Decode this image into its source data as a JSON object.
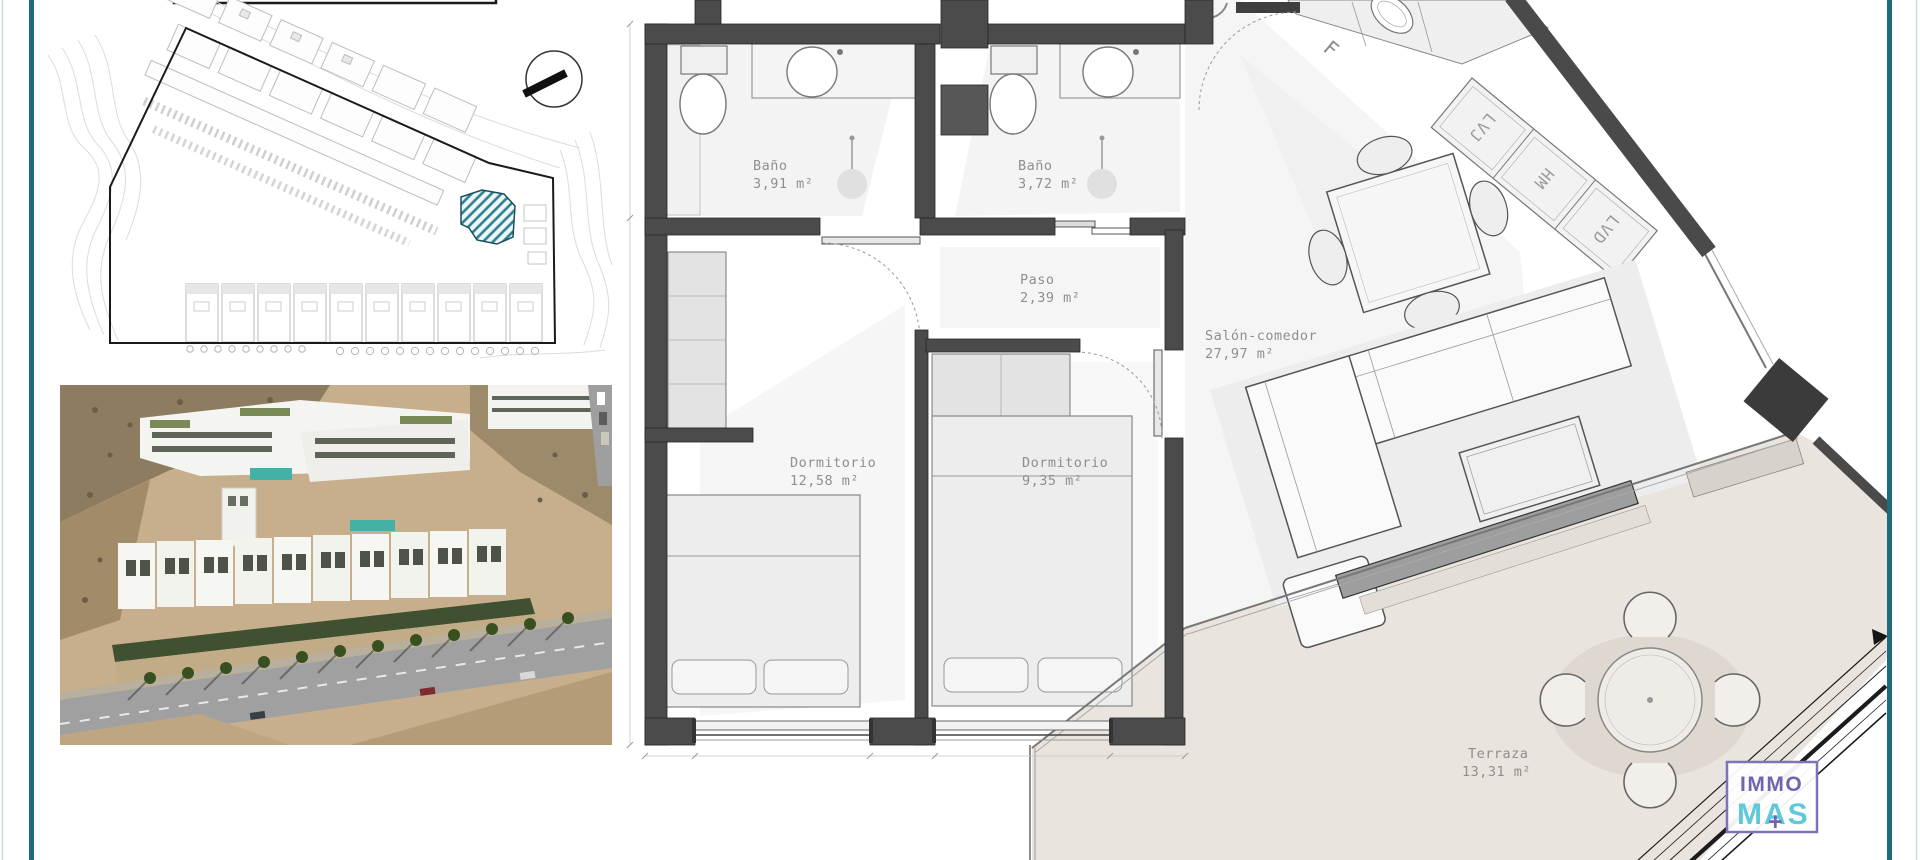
{
  "page": {
    "frame_color": "#1f6b79",
    "outer_line_color": "#c9dbdf"
  },
  "site_plan": {
    "highlight_color": "#2f7f90"
  },
  "floor_plan": {
    "rooms": {
      "bano1": {
        "name": "Baño",
        "area": "3,91 m²"
      },
      "bano2": {
        "name": "Baño",
        "area": "3,72 m²"
      },
      "paso": {
        "name": "Paso",
        "area": "2,39 m²"
      },
      "dormitorio1": {
        "name": "Dormitorio",
        "area": "12,58 m²"
      },
      "dormitorio2": {
        "name": "Dormitorio",
        "area": "9,35 m²"
      },
      "salon": {
        "name": "Salón-comedor",
        "area": "27,97 m²"
      },
      "terraza": {
        "name": "Terraza",
        "area": "13,31 m²"
      }
    },
    "appliances": {
      "fridge": "F",
      "dishwasher": "LVJ",
      "oven_microwave": "HM",
      "washer": "LVD"
    }
  },
  "logo": {
    "line1": "IMMO",
    "line2": "MAS",
    "plus": "+",
    "line1_color": "#6f66ad",
    "line2_color": "#5fc9da",
    "border_color": "#7d74b8"
  }
}
